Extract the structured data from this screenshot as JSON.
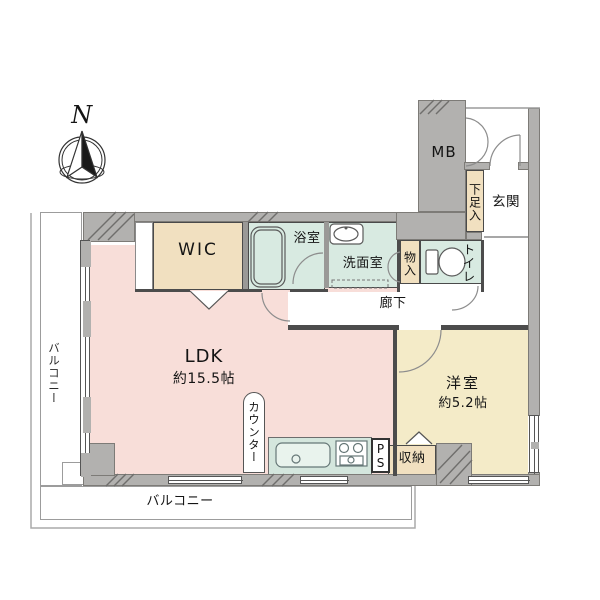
{
  "compass": {
    "north": "N"
  },
  "labels": {
    "mb": "MB",
    "shoe_box": "下足入",
    "entrance": "玄関",
    "wic": "WIC",
    "bath": "浴室",
    "washroom": "洗面室",
    "small_closet": "物入",
    "toilet": "トイレ",
    "hallway": "廊下",
    "balcony_left": "バルコニー",
    "ldk_name": "LDK",
    "ldk_size": "約15.5帖",
    "counter": "カウンター",
    "pipe_space": "PS",
    "storage": "収納",
    "western_room_name": "洋室",
    "western_room_size": "約5.2帖",
    "balcony_bottom": "バルコニー"
  },
  "icons": [
    "compass-icon",
    "bathtub-icon",
    "washbasin-icon",
    "toilet-icon",
    "kitchen-sink-icon",
    "stove-icon",
    "door-swing-icon",
    "folding-door-icon"
  ],
  "colors": {
    "ldk_pink": "#f8ded9",
    "closet_beige": "#f1e0c0",
    "western_yellow": "#f4ebc8",
    "wet_area_teal": "#d8eae1",
    "kitchen_teal": "#d4e6dd",
    "wall_gray": "#b2b1af"
  }
}
